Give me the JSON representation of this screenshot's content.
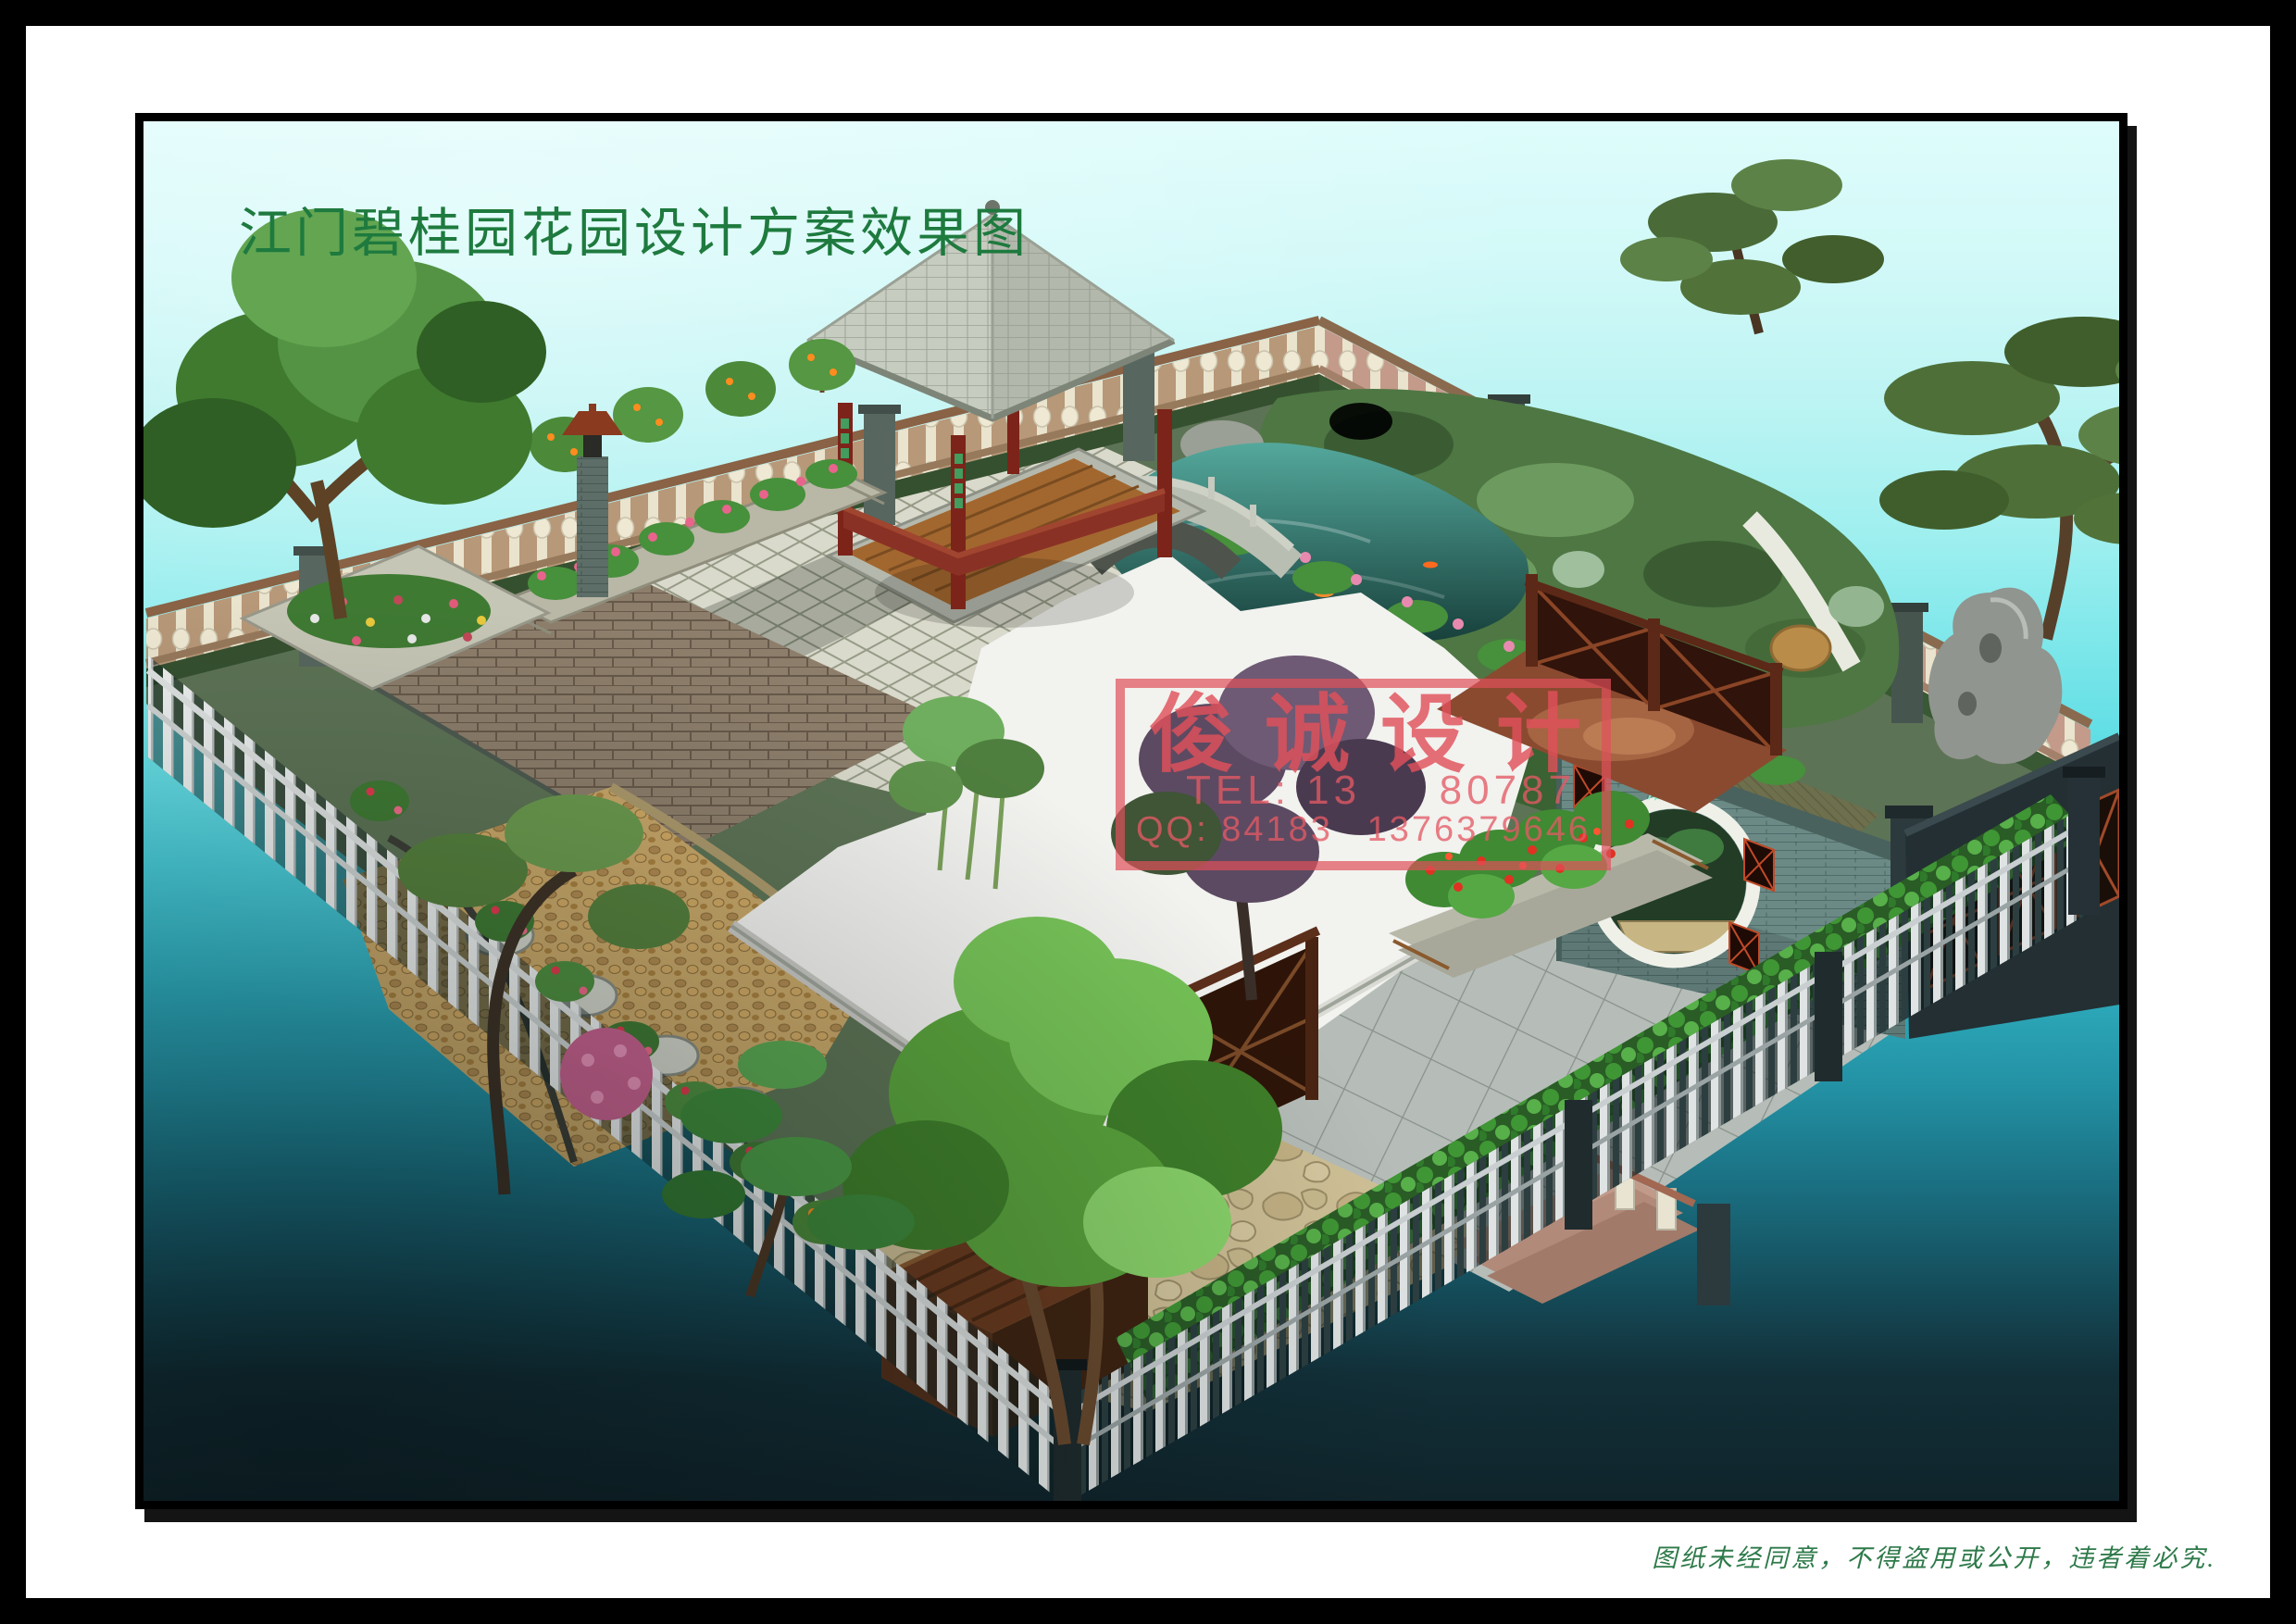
{
  "header": {
    "title": "江门碧桂园花园设计方案效果图"
  },
  "footer": {
    "note": "图纸未经同意，不得盗用或公开，违者着必究."
  },
  "watermark": {
    "char_1": "俊",
    "char_2": "诚",
    "char_3": "设",
    "char_4": "计",
    "tel_prefix": "TEL: 13",
    "tel_suffix": "80787",
    "qq_prefix": "QQ: 84183",
    "qq_suffix": "1376379646"
  },
  "scene": {
    "moon_gate_plaque": "浴游"
  },
  "colors": {
    "title_green": "#1e7a3e",
    "note_green": "#2e7a4a",
    "watermark_red": "#e0505a",
    "sky_top": "#defcfb",
    "turquoise": "#3fc9d6",
    "deep_teal": "#10242b",
    "pavilion_wood": "#7c241a",
    "moon_wall": "#6b8a86",
    "paving_light": "#d9dacb"
  }
}
